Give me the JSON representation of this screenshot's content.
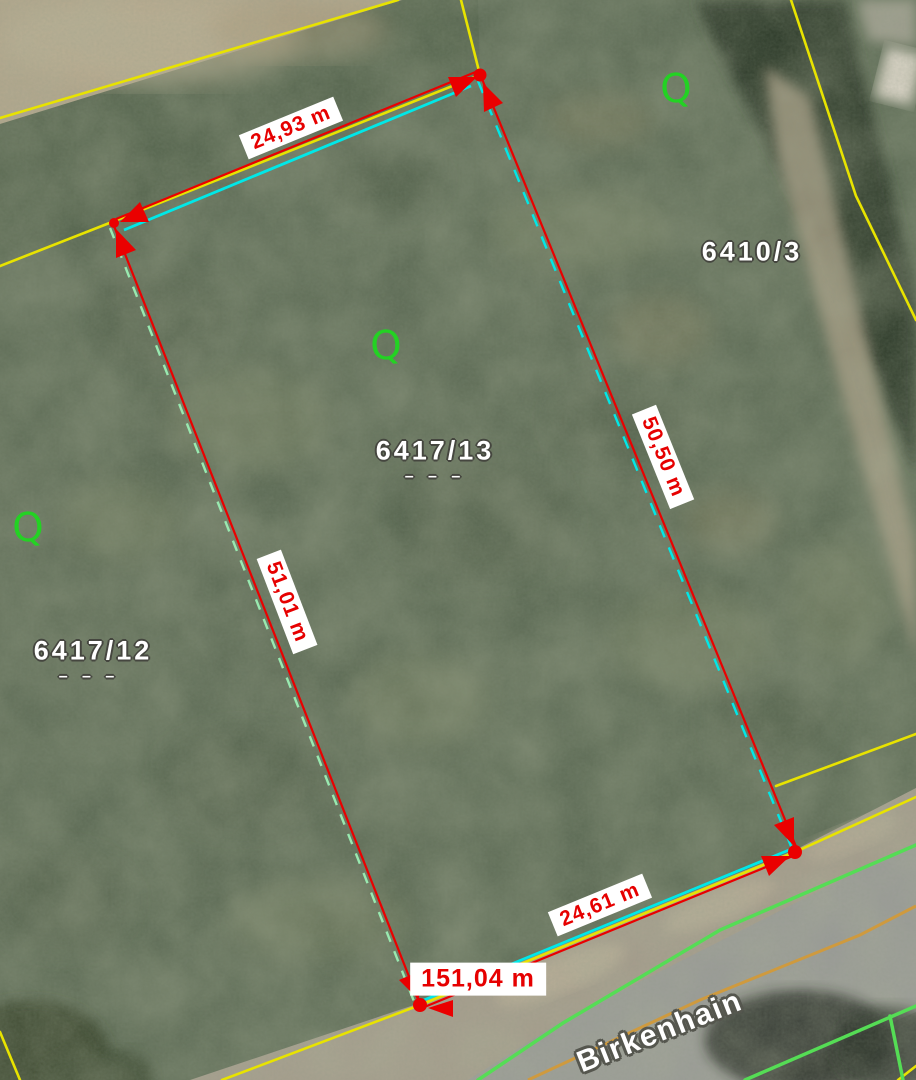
{
  "street": {
    "name": "Birkenhain"
  },
  "parcels": {
    "right": {
      "id": "6410/3"
    },
    "center": {
      "id": "6417/13",
      "marks": "– – –"
    },
    "left": {
      "id": "6417/12",
      "marks": "– – –"
    }
  },
  "measurements": {
    "top_edge": "24,93 m",
    "left_edge": "51,01 m",
    "right_edge": "50,50 m",
    "bottom_edge": "24,61 m",
    "perimeter_total": "151,04 m"
  },
  "symbols": {
    "grassland_glyph": "Q"
  },
  "colors": {
    "boundary_yellow": "#e8e300",
    "measure_red": "#ea0000",
    "highlight_cyan": "#00e8e8",
    "highlight_mint": "#99e9b0",
    "road_edge_green": "#55dd55",
    "road_center_orange": "#cf9a3e",
    "measure_text_red": "#e60000",
    "parcel_label_white": "#ffffff",
    "landuse_green": "#23d223"
  }
}
